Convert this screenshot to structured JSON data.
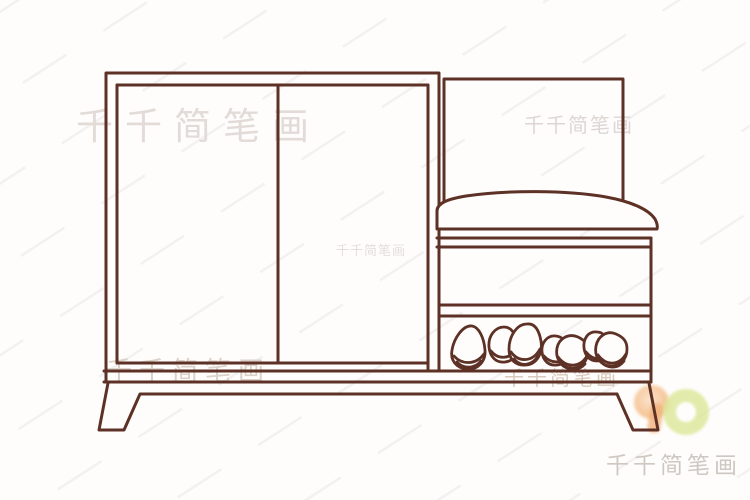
{
  "meta": {
    "description": "Simple hand-drawn line illustration of a shoe cabinet with a cushioned bench seat, sliding doors, open shoe shelf with four groups of shoes, and splayed legs",
    "style": "children's outline sketch (jianbihua)"
  },
  "colors": {
    "line": "#5d3125",
    "background": "#fefdfc",
    "watermark_text": "#d6cfca",
    "logo_orange": "#f0a868",
    "logo_green": "#dce797"
  },
  "watermarks": [
    {
      "text": "千千简笔画"
    },
    {
      "text": "千千简笔画"
    },
    {
      "text": "千千简笔画"
    },
    {
      "text": "千千简笔画"
    },
    {
      "text": "千千简笔画"
    },
    {
      "text": "千千简笔画"
    }
  ],
  "logo": {
    "name": "qianqian-jianbihua-logo"
  }
}
